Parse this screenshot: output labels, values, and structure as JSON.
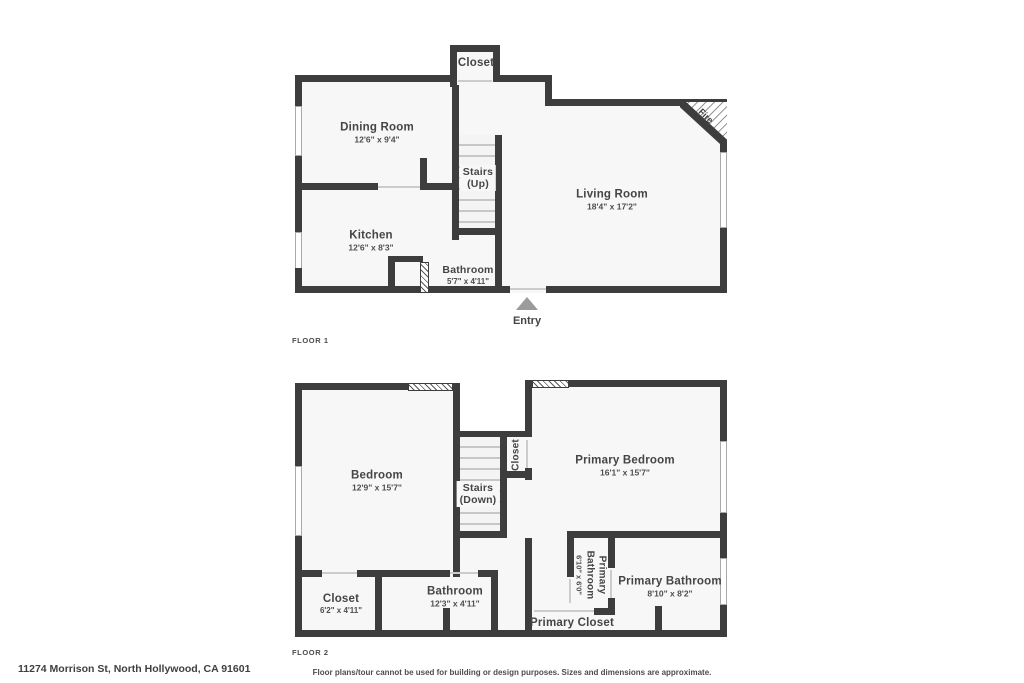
{
  "floor1": {
    "tag": "FLOOR 1",
    "rooms": {
      "closet": {
        "name": "Closet"
      },
      "dining": {
        "name": "Dining Room",
        "dims": "12'6\" x 9'4\""
      },
      "stairs": {
        "name": "Stairs",
        "name2": "(Up)"
      },
      "living": {
        "name": "Living Room",
        "dims": "18'4\" x 17'2\""
      },
      "kitchen": {
        "name": "Kitchen",
        "dims": "12'6\" x 8'3\""
      },
      "bath": {
        "name": "Bathroom",
        "dims": "5'7\" x 4'11\""
      },
      "fire": {
        "name": "Fire"
      },
      "entry": {
        "name": "Entry"
      }
    }
  },
  "floor2": {
    "tag": "FLOOR 2",
    "rooms": {
      "bedroom": {
        "name": "Bedroom",
        "dims": "12'9\" x 15'7\""
      },
      "stairs": {
        "name": "Stairs",
        "name2": "(Down)"
      },
      "hallCloset": {
        "name": "Closet"
      },
      "primaryBedroom": {
        "name": "Primary Bedroom",
        "dims": "16'1\" x 15'7\""
      },
      "closet": {
        "name": "Closet",
        "dims": "6'2\" x 4'11\""
      },
      "bathroom": {
        "name": "Bathroom",
        "dims": "12'3\" x 4'11\""
      },
      "primaryBathSmall": {
        "name": "Primary Bathroom",
        "dims": "6'10\" x 6'0\""
      },
      "primaryBath": {
        "name": "Primary Bathroom",
        "dims": "8'10\" x 8'2\""
      },
      "primaryCloset": {
        "name": "Primary Closet"
      }
    }
  },
  "footer": {
    "address": "11274 Morrison St, North Hollywood, CA 91601",
    "disclaimer": "Floor plans/tour cannot be used for building or design purposes. Sizes and dimensions are approximate."
  },
  "colors": {
    "wall": "#3d3d3d",
    "room_fill": "#f7f7f7",
    "entry_marker": "#9b9b9b"
  }
}
